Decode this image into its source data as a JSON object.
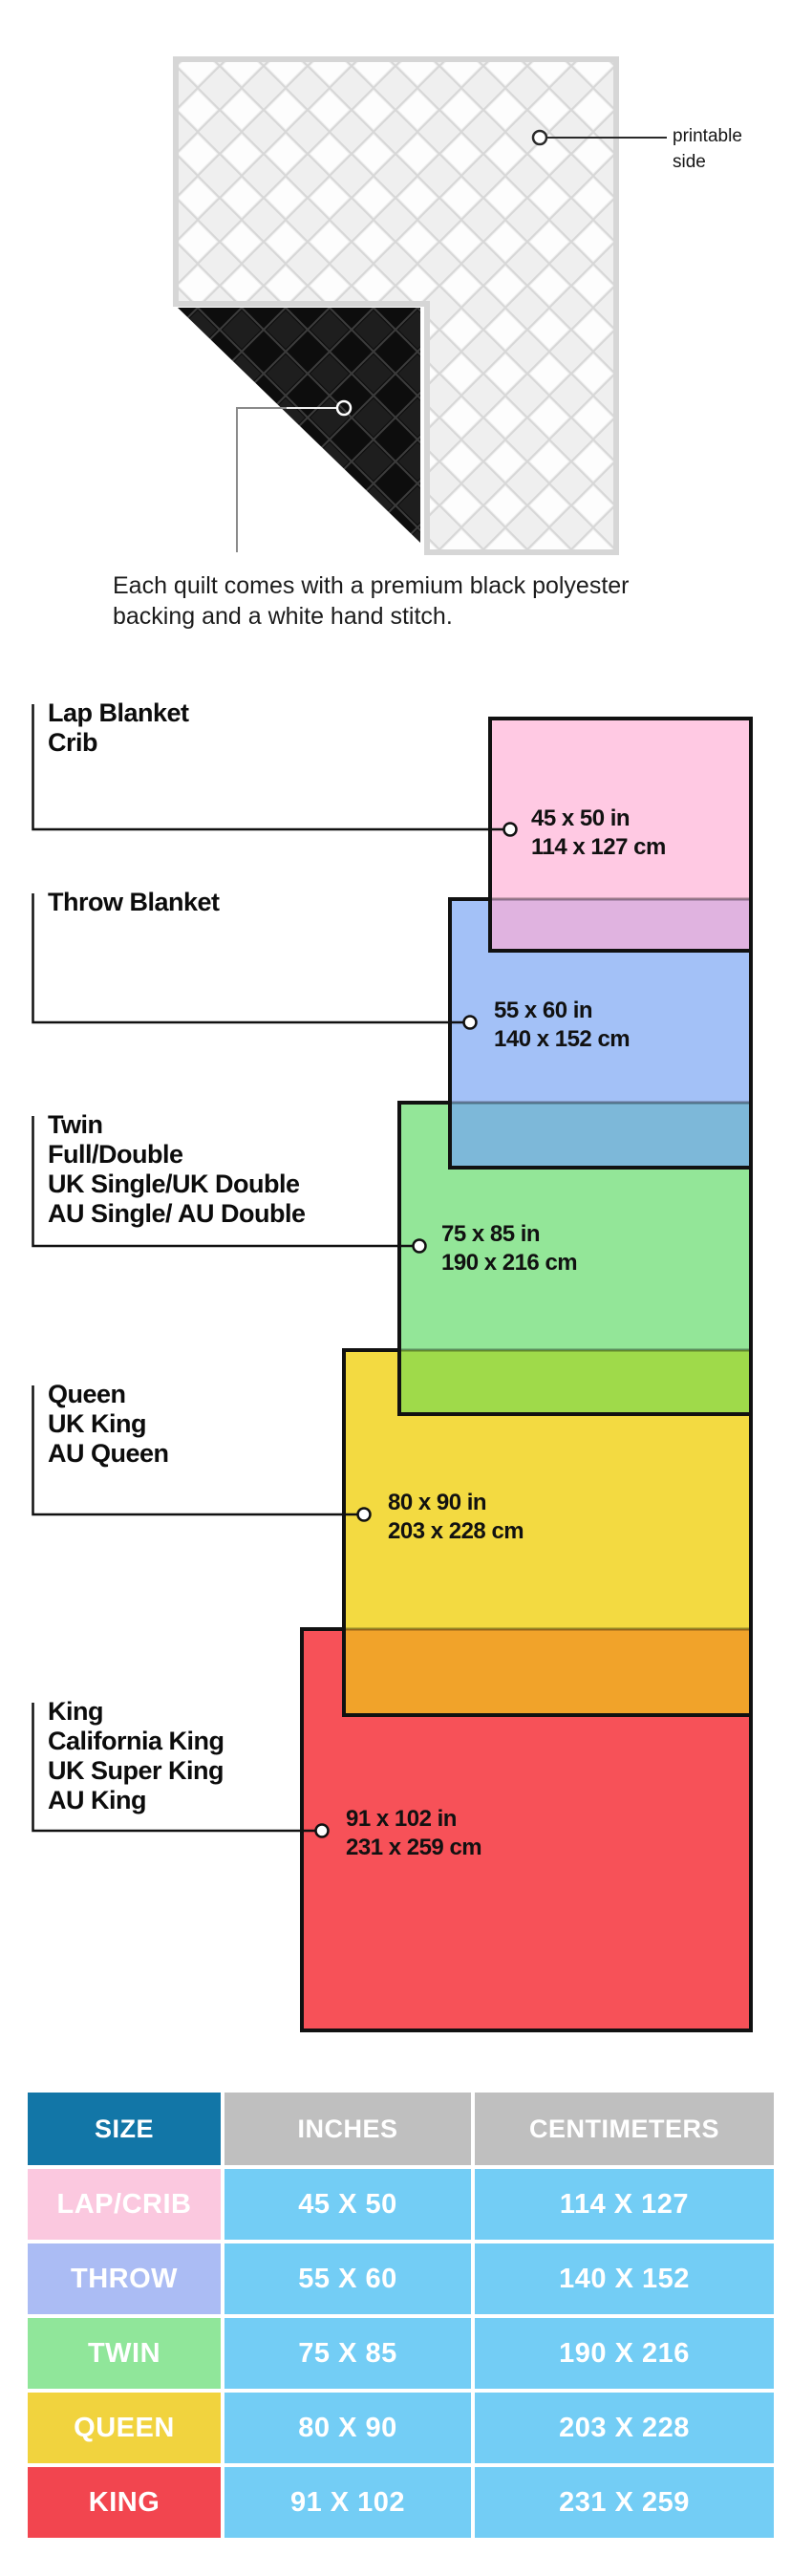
{
  "quilt_note": {
    "printable_label_lines": [
      "printable",
      "side"
    ],
    "caption_lines": [
      "Each quilt comes with a premium black polyester",
      "backing and a white hand stitch."
    ]
  },
  "diagram": {
    "line_color": "#111111",
    "sizes": [
      {
        "key": "lap_crib",
        "label_lines": [
          "Lap Blanket",
          "Crib"
        ],
        "inches": "45 x 50 in",
        "centimeters": "114 x 127 cm",
        "fill": "#FFC9E3",
        "overlap_fill": "#E0B3E0"
      },
      {
        "key": "throw",
        "label_lines": [
          "Throw Blanket"
        ],
        "inches": "55 x 60 in",
        "centimeters": "140 x 152 cm",
        "fill": "#A3C1F7",
        "overlap_fill": "#7DB8D9"
      },
      {
        "key": "twin",
        "label_lines": [
          "Twin",
          "Full/Double",
          "UK Single/UK Double",
          "AU Single/ AU Double"
        ],
        "inches": "75 x 85 in",
        "centimeters": "190 x 216 cm",
        "fill": "#93E698",
        "overlap_fill": "#9FDA4A"
      },
      {
        "key": "queen",
        "label_lines": [
          "Queen",
          "UK King",
          "AU Queen"
        ],
        "inches": "80 x 90 in",
        "centimeters": "203 x 228 cm",
        "fill": "#F3DA41",
        "overlap_fill": "#F1A32A"
      },
      {
        "key": "king",
        "label_lines": [
          "King",
          "California King",
          "UK Super King",
          "AU King"
        ],
        "inches": "91 x 102 in",
        "centimeters": "231 x 259 cm",
        "fill": "#F75158",
        "overlap_fill": ""
      }
    ]
  },
  "size_table": {
    "headers": [
      "SIZE",
      "INCHES",
      "CENTIMETERS"
    ],
    "header_size_bg": "#1276A7",
    "header_other_bg": "#BFBFBF",
    "data_cell_bg": "#73CDF5",
    "rows": [
      {
        "size": "LAP/CRIB",
        "inches": "45 X 50",
        "centimeters": "114 X 127",
        "bg": "#FBC8DF"
      },
      {
        "size": "THROW",
        "inches": "55 X 60",
        "centimeters": "140 X 152",
        "bg": "#ABBCF4"
      },
      {
        "size": "TWIN",
        "inches": "75 X 85",
        "centimeters": "190 X 216",
        "bg": "#90E69A"
      },
      {
        "size": "QUEEN",
        "inches": "80 X 90",
        "centimeters": "203 X 228",
        "bg": "#F1D33E"
      },
      {
        "size": "KING",
        "inches": "91 X 102",
        "centimeters": "231 X 259",
        "bg": "#F2454F"
      }
    ]
  }
}
